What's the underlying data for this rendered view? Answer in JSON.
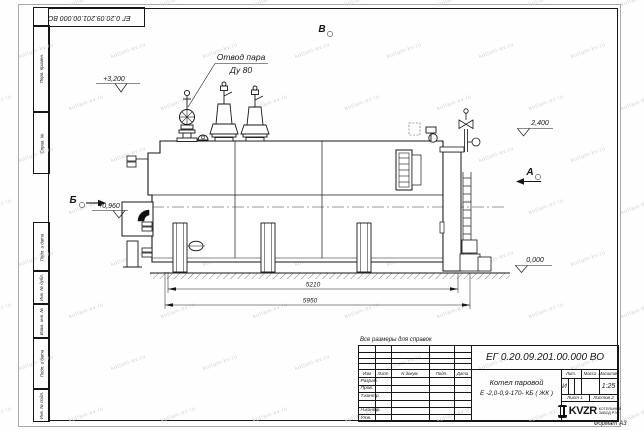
{
  "sheet": {
    "doc_number_rotated": "ЕГ 0.20.09.201.00.000  ВО",
    "reference_note": "Все размеры для справок",
    "format_label": "Формат А3"
  },
  "frame_labels": {
    "left_column": [
      "Перв. примен.",
      "Справ. №",
      "Подп. и дата",
      "Инв. № дубл.",
      "Взам. инв. №",
      "Подп. и дата",
      "Инв. № подл."
    ]
  },
  "annotations": {
    "steam_outlet_line1": "Отвод пара",
    "steam_outlet_line2": "Ду 80",
    "elev_top": "+3,200",
    "elev_right": "2,400",
    "elev_burner": "+0,960",
    "elev_ground": "0,000",
    "section_b_letter": "Б",
    "view_v_letter": "В",
    "view_a_letter": "А",
    "dim_boiler": "5210",
    "dim_overall": "5950"
  },
  "title_block": {
    "doc_number": "ЕГ 0.20.09.201.00.000  ВО",
    "product_line1": "Котел паровой",
    "product_line2": "Е -2,0-0,9-170- КБ ( ЖК )",
    "col_lit": "Лит.",
    "col_mass": "Масса",
    "col_scale": "Масштаб",
    "lit_value": "И",
    "scale_value": "1:25",
    "sheet_label": "Лист 1",
    "sheets_label": "Листов 2",
    "header_cols": [
      "Изм",
      "Лист",
      "N докум.",
      "Подп.",
      "Дата"
    ],
    "row_labels": [
      "Разраб.",
      "Пров.",
      "Т.контр.",
      "Н.контр.",
      "Утв."
    ],
    "logo_text": "KVZR",
    "logo_caption1": "КОТЕЛЬНЫЙ",
    "logo_caption2": "ЗАВОД РЭП"
  },
  "watermark": {
    "text": "kotlam-kv.ru"
  }
}
